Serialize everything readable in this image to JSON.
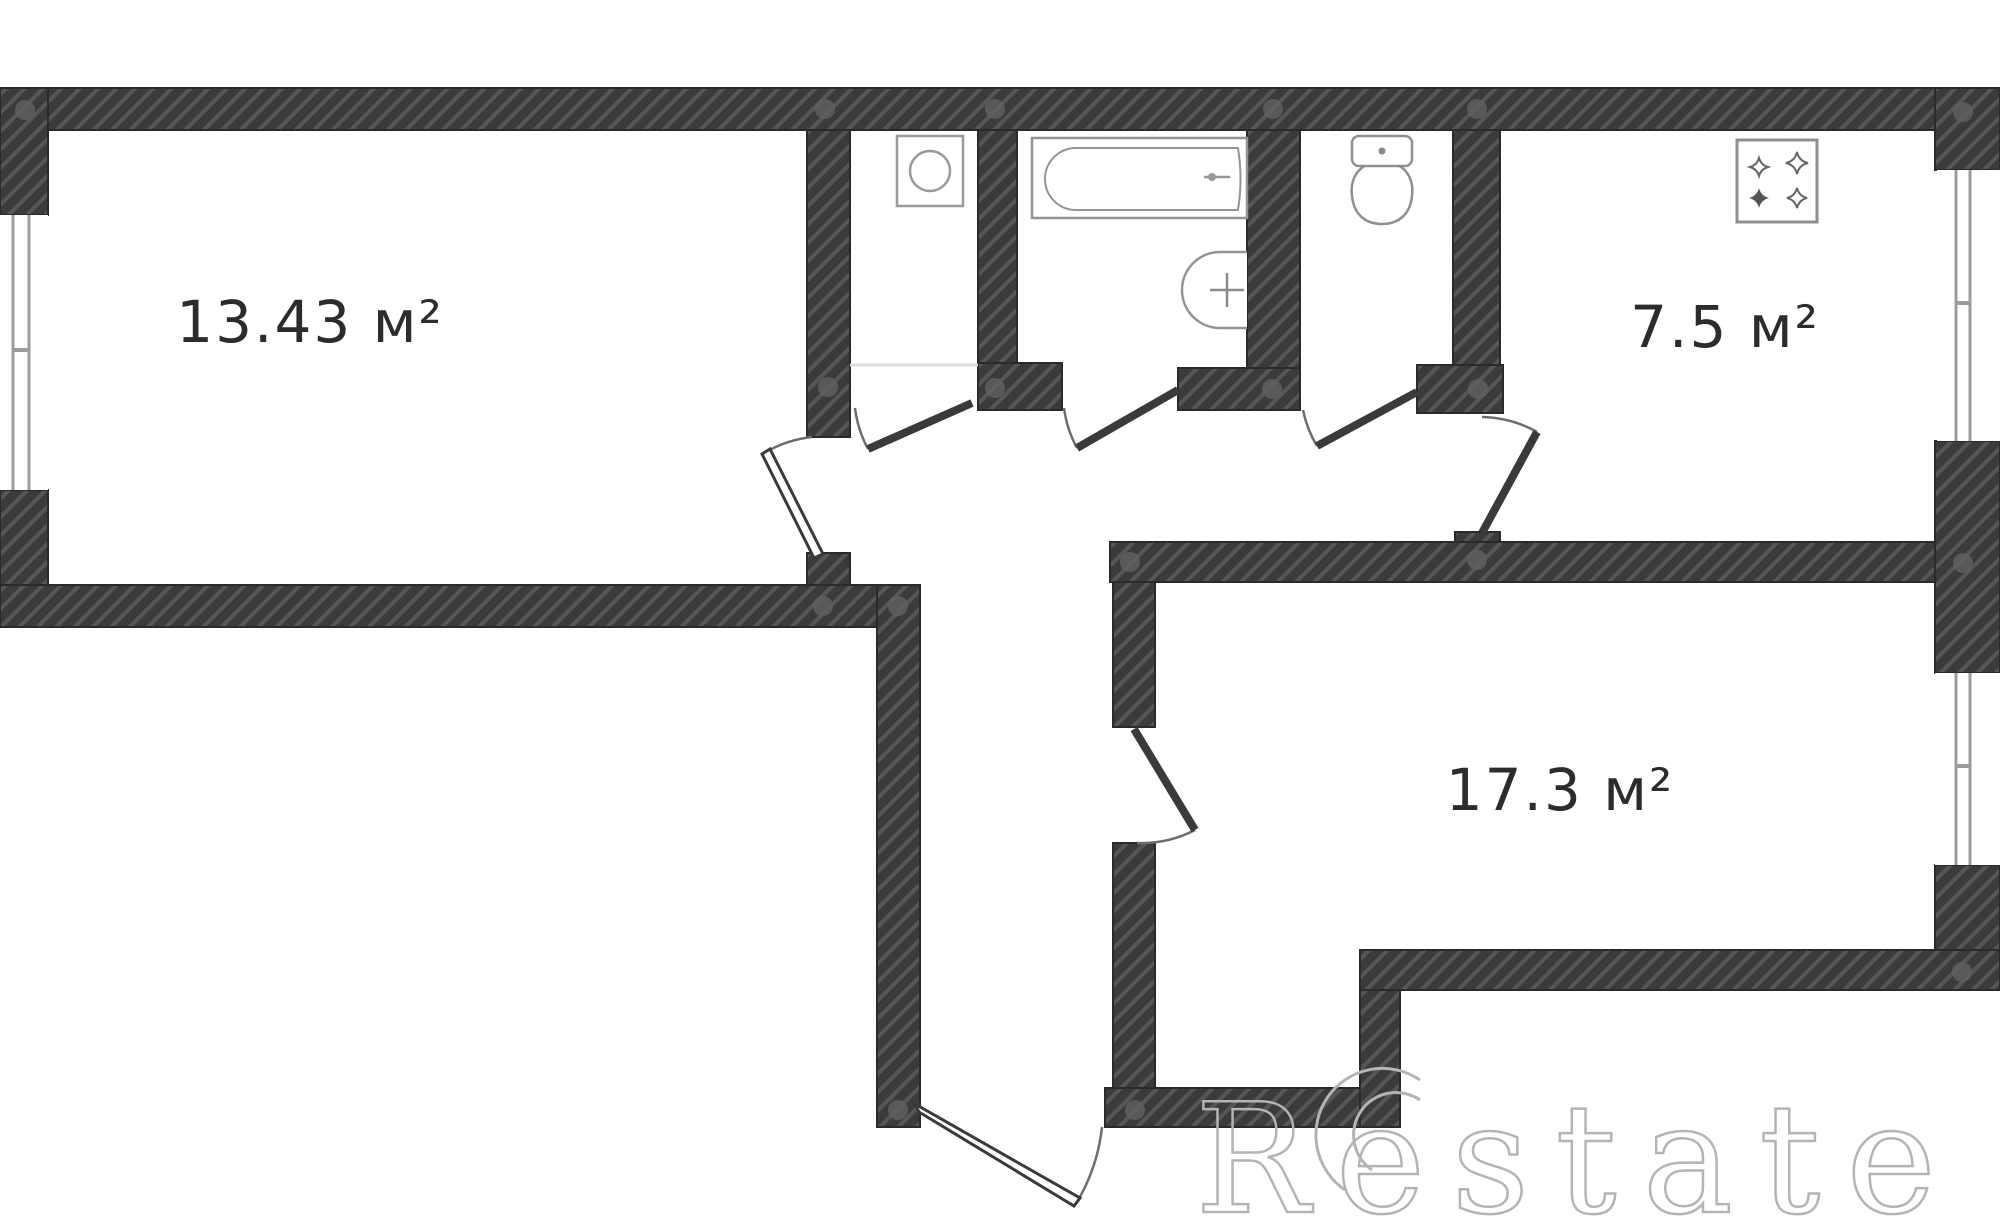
{
  "plan_title": "apartment-floor-plan",
  "rooms": [
    {
      "name": "living-room",
      "area_label": "13.43 м²"
    },
    {
      "name": "kitchen",
      "area_label": "7.5 м²"
    },
    {
      "name": "bedroom",
      "area_label": "17.3 м²"
    }
  ],
  "fixtures": [
    {
      "name": "bathtub"
    },
    {
      "name": "sink"
    },
    {
      "name": "toilet"
    },
    {
      "name": "stove"
    },
    {
      "name": "washing-machine"
    }
  ],
  "watermark": {
    "brand": "Restate"
  },
  "colors": {
    "wall": "#3b3b3b",
    "hatch_stripe": "#565656",
    "wall_outline": "#2a2a2a",
    "fixture_line": "#949494",
    "door_line": "#3a3a3a",
    "arc_line": "#6d6d6d",
    "dot": "#5f5f5f",
    "label": "#2c2c2c",
    "threshold": "#dcdcdc",
    "watermark": "#b4b4b4",
    "background": "#ffffff"
  }
}
